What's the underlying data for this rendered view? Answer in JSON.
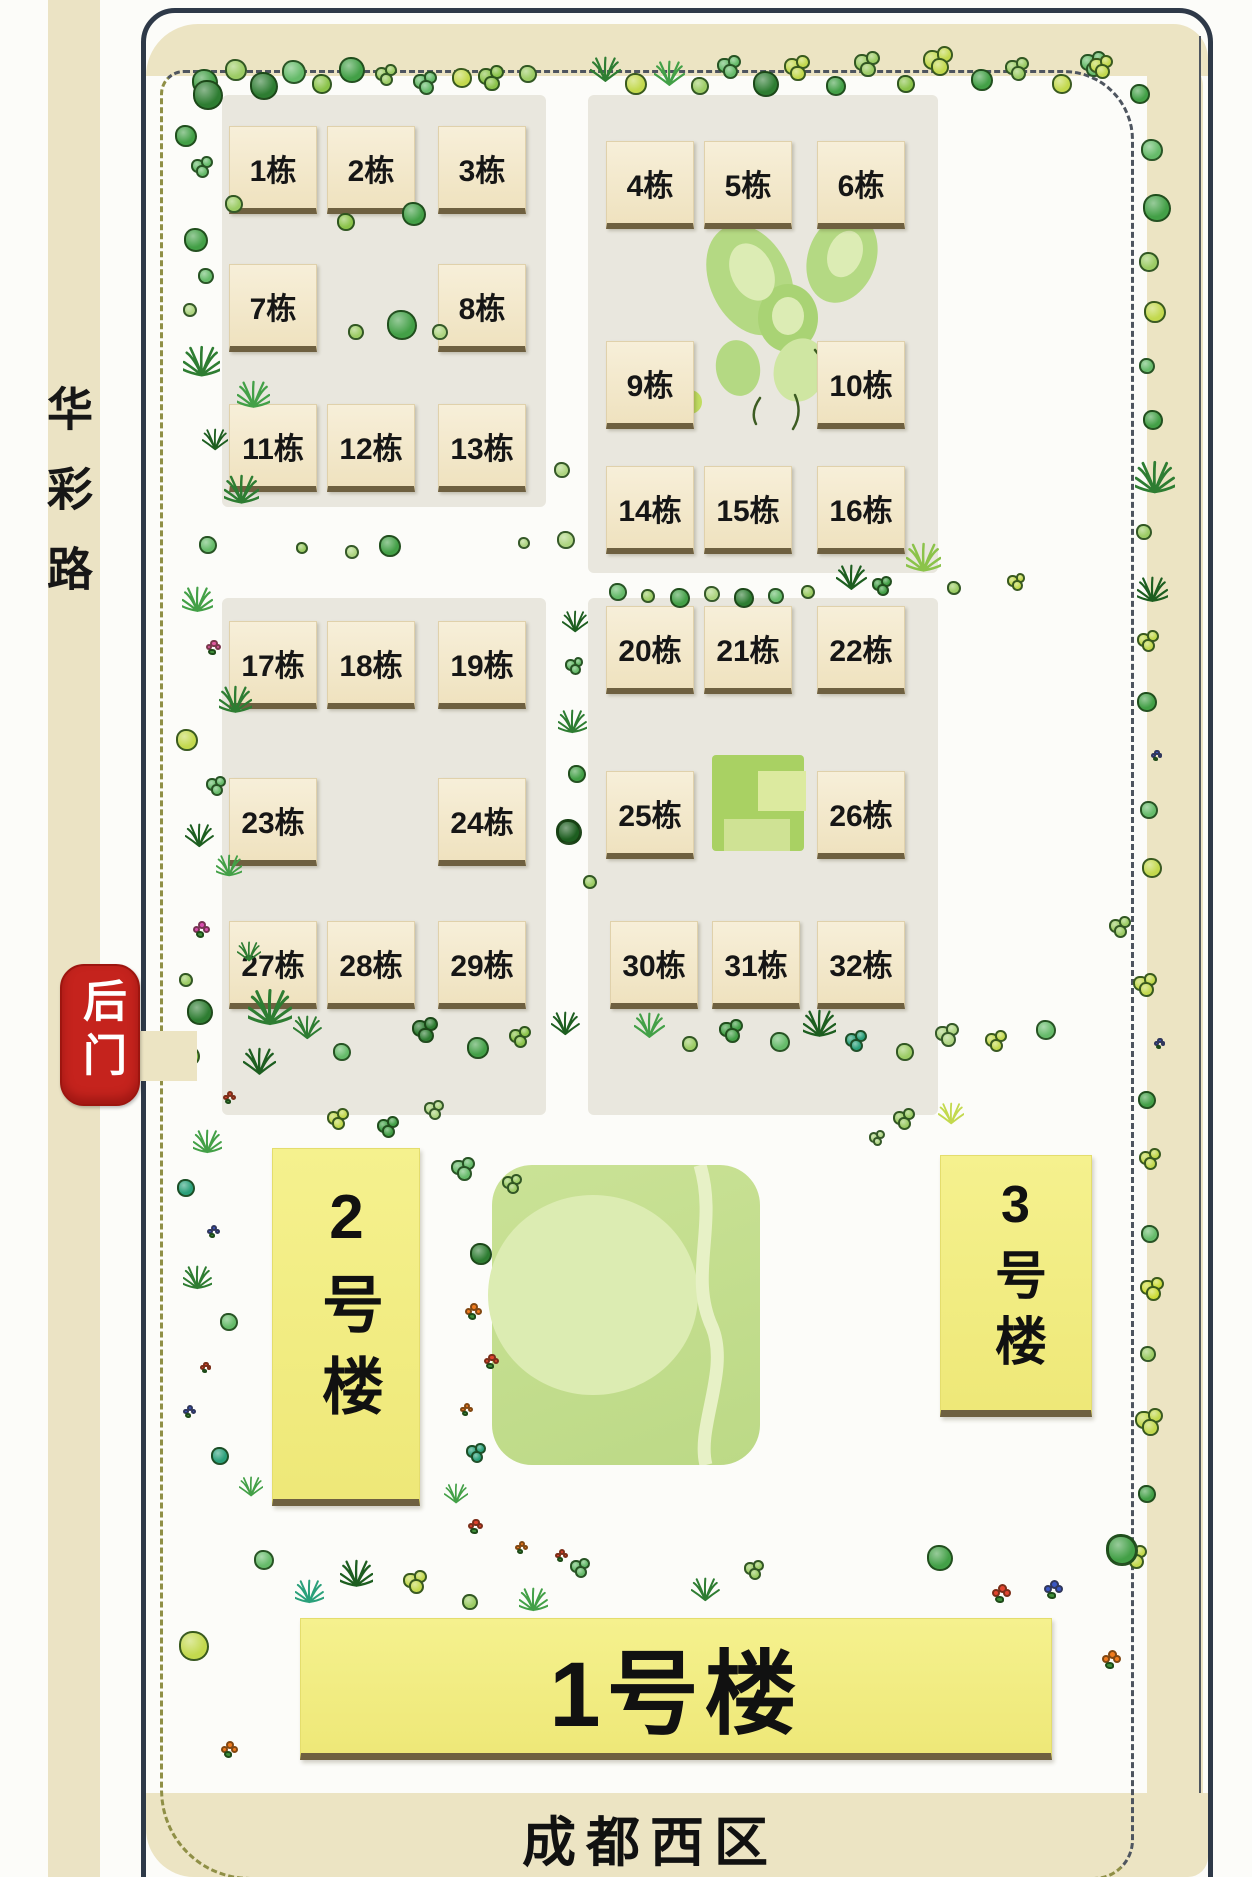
{
  "region": {
    "name": "成都西区"
  },
  "roads": {
    "west_road": "华彩路"
  },
  "gate": {
    "back_gate": "后门"
  },
  "buildings": {
    "unit_suffix": "栋",
    "numbered": [
      {
        "n": 1,
        "label": "1栋"
      },
      {
        "n": 2,
        "label": "2栋"
      },
      {
        "n": 3,
        "label": "3栋"
      },
      {
        "n": 4,
        "label": "4栋"
      },
      {
        "n": 5,
        "label": "5栋"
      },
      {
        "n": 6,
        "label": "6栋"
      },
      {
        "n": 7,
        "label": "7栋"
      },
      {
        "n": 8,
        "label": "8栋"
      },
      {
        "n": 9,
        "label": "9栋"
      },
      {
        "n": 10,
        "label": "10栋"
      },
      {
        "n": 11,
        "label": "11栋"
      },
      {
        "n": 12,
        "label": "12栋"
      },
      {
        "n": 13,
        "label": "13栋"
      },
      {
        "n": 14,
        "label": "14栋"
      },
      {
        "n": 15,
        "label": "15栋"
      },
      {
        "n": 16,
        "label": "16栋"
      },
      {
        "n": 17,
        "label": "17栋"
      },
      {
        "n": 18,
        "label": "18栋"
      },
      {
        "n": 19,
        "label": "19栋"
      },
      {
        "n": 20,
        "label": "20栋"
      },
      {
        "n": 21,
        "label": "21栋"
      },
      {
        "n": 22,
        "label": "22栋"
      },
      {
        "n": 23,
        "label": "23栋"
      },
      {
        "n": 24,
        "label": "24栋"
      },
      {
        "n": 25,
        "label": "25栋"
      },
      {
        "n": 26,
        "label": "26栋"
      },
      {
        "n": 27,
        "label": "27栋"
      },
      {
        "n": 28,
        "label": "28栋"
      },
      {
        "n": 29,
        "label": "29栋"
      },
      {
        "n": 30,
        "label": "30栋"
      },
      {
        "n": 31,
        "label": "31栋"
      },
      {
        "n": 32,
        "label": "32栋"
      }
    ],
    "towers": [
      {
        "id": "tower-1",
        "label": "1号楼"
      },
      {
        "id": "tower-2",
        "label": "2号楼"
      },
      {
        "id": "tower-3",
        "label": "3号楼"
      }
    ]
  },
  "colors": {
    "boundary_line": "#2e3948",
    "ring_road": "#ece4c3",
    "inner_dashed": "#8f8f46",
    "block_ground": "#e9e7de",
    "building_face": "#f5ecd3",
    "building_shadow": "#6e6040",
    "tower_fill": "#f2ee82",
    "park_green": "#c5df92",
    "park_circle": "#dcecb2",
    "stamp_red": "#c5231d",
    "text": "#141414"
  },
  "icons": {
    "bush": "bush-icon",
    "tree": "tree-icon",
    "grass": "grass-icon",
    "palm": "palm-icon",
    "flower": "flower-icon",
    "butterfly_lawn": "butterfly-lawn-icon",
    "square_lawn": "square-lawn-icon",
    "back_gate_stamp": "stamp-icon"
  }
}
